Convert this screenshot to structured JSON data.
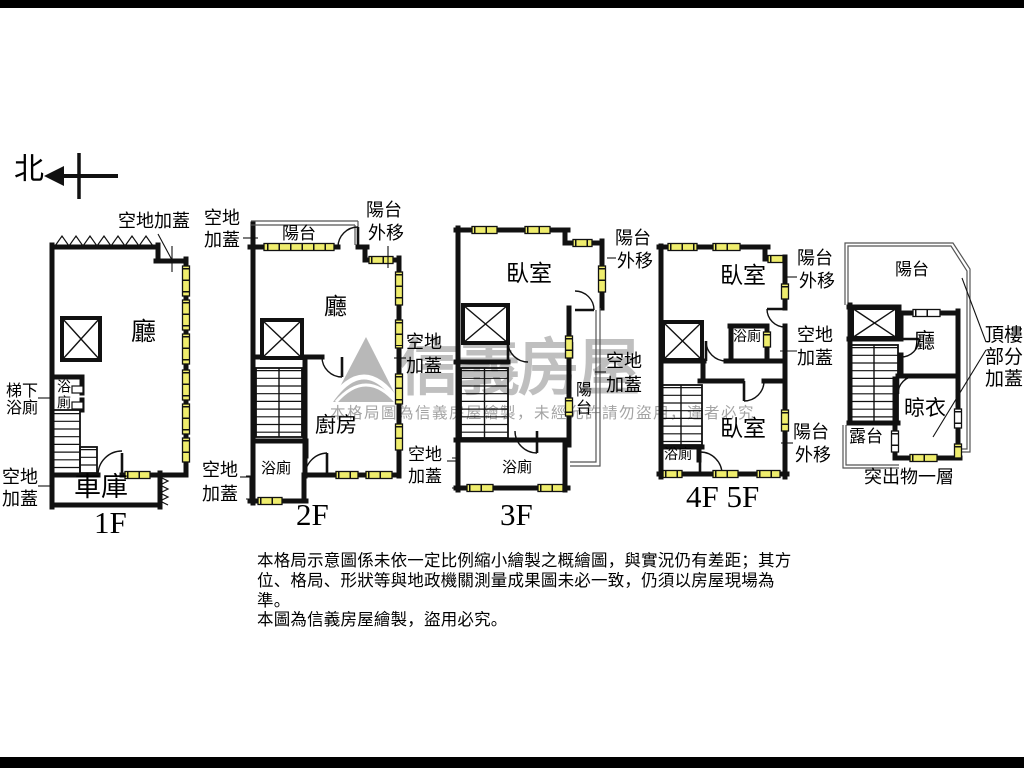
{
  "compass": {
    "north": "北"
  },
  "terms": {
    "kongdi_jiagai": "空地加蓋",
    "kongdi": "空地",
    "jiagai": "加蓋",
    "yangtai": "陽台",
    "waiyi": "外移",
    "ting": "廳",
    "tixia": "梯下",
    "yuce": "浴廁",
    "cheku": "車庫",
    "chufang": "廚房",
    "woshi": "臥室",
    "liangyi": "晾衣",
    "lutai": "露台",
    "tuchuwu_yiceng": "突出物一層",
    "dinglou": "頂樓",
    "bufen": "部分"
  },
  "floors": [
    {
      "label": "1F"
    },
    {
      "label": "2F"
    },
    {
      "label": "3F"
    },
    {
      "label": "4F 5F"
    }
  ],
  "watermark": {
    "brand": "信義房屋",
    "notice": "本格局圖為信義房屋繪製，未經允許請勿盜用，違者必究"
  },
  "disclaimer": {
    "line1": "本格局示意圖係未依一定比例縮小繪製之概繪圖，與實況仍有差距；其方",
    "line2": "位、格局、形狀等與地政機關測量成果圖未必一致，仍須以房屋現場為準。",
    "line3": "本圖為信義房屋繪製，盜用必究。"
  }
}
